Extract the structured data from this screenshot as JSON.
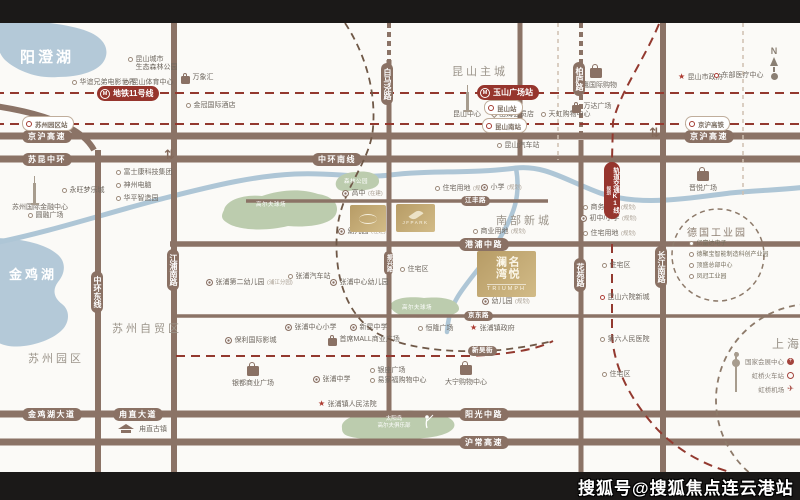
{
  "watermark": "搜狐号@搜狐焦点连云港站",
  "compass": {
    "label": "N"
  },
  "colors": {
    "road": "#8b7366",
    "metro_red": "#96352d",
    "water": "#aec6d6",
    "park": "#bcccae",
    "gold": "#c3ab74"
  },
  "zones": [
    {
      "label": "昆山主城",
      "x": 452,
      "y": 63,
      "size": 11
    },
    {
      "label": "南部新城",
      "x": 496,
      "y": 212,
      "size": 11
    },
    {
      "label": "苏州自贸区",
      "x": 112,
      "y": 320,
      "size": 11
    },
    {
      "label": "苏州园区",
      "x": 28,
      "y": 350,
      "size": 11
    },
    {
      "label": "上海",
      "x": 772,
      "y": 335,
      "size": 12
    }
  ],
  "lakes": [
    {
      "label": "阳澄湖",
      "x": 20,
      "y": 46,
      "size": 15
    },
    {
      "label": "金鸡湖",
      "x": 9,
      "y": 264,
      "size": 13
    }
  ],
  "roads_h": [
    {
      "label": "京沪高速",
      "x": 22,
      "y": 130
    },
    {
      "label": "京沪高速",
      "x": 684,
      "y": 130
    },
    {
      "label": "苏昆中环",
      "x": 22,
      "y": 153
    },
    {
      "label": "中环南线",
      "x": 312,
      "y": 153
    },
    {
      "label": "江丰路",
      "x": 461,
      "y": 196,
      "sm": true
    },
    {
      "label": "港浦中路",
      "x": 459,
      "y": 238
    },
    {
      "label": "京东路",
      "x": 464,
      "y": 311,
      "sm": true
    },
    {
      "label": "新吴街",
      "x": 468,
      "y": 346,
      "sm": true
    },
    {
      "label": "金鸡湖大道",
      "x": 22,
      "y": 408
    },
    {
      "label": "甪直大道",
      "x": 113,
      "y": 408
    },
    {
      "label": "阳光中路",
      "x": 459,
      "y": 408
    },
    {
      "label": "沪常高速",
      "x": 459,
      "y": 436
    }
  ],
  "roads_v": [
    {
      "label": "中环东线",
      "x": 91,
      "y": 271
    },
    {
      "label": "江浦南路",
      "x": 167,
      "y": 249
    },
    {
      "label": "白马泾路",
      "x": 381,
      "y": 63
    },
    {
      "label": "振兴路",
      "x": 384,
      "y": 251,
      "sm": true
    },
    {
      "label": "柏庐路",
      "x": 573,
      "y": 62
    },
    {
      "label": "花苑路",
      "x": 574,
      "y": 258
    },
    {
      "label": "长江南路",
      "x": 655,
      "y": 246
    }
  ],
  "metro_badges": [
    {
      "label": "地铁11号线",
      "x": 97,
      "y": 86
    },
    {
      "label": "玉山广场站",
      "x": 477,
      "y": 85
    }
  ],
  "k1_badge": {
    "label": "轨道交通K1线",
    "sub": "规划",
    "x": 604,
    "y": 162
  },
  "stations": [
    {
      "label": "苏州园区站",
      "x": 22,
      "y": 116
    },
    {
      "label": "昆山站",
      "x": 484,
      "y": 100
    },
    {
      "label": "昆山南站",
      "x": 482,
      "y": 118
    },
    {
      "label": "京沪高铁",
      "x": 685,
      "y": 116
    }
  ],
  "pois": [
    {
      "m": "dot",
      "label": "昆山城市",
      "label2": "生态森林公园",
      "x": 128,
      "y": 56
    },
    {
      "m": "dot",
      "label": "昆山体育中心",
      "x": 124,
      "y": 79
    },
    {
      "m": "bag",
      "label": "万象汇",
      "x": 181,
      "y": 74
    },
    {
      "m": "dot",
      "label": "华谊兄弟电影世界",
      "x": 72,
      "y": 79
    },
    {
      "m": "dot",
      "label": "金冠国际酒店",
      "x": 186,
      "y": 102
    },
    {
      "m": "dot",
      "label": "富士康科技集团",
      "x": 116,
      "y": 169
    },
    {
      "m": "dot",
      "label": "神州电脑",
      "x": 116,
      "y": 182
    },
    {
      "m": "dot",
      "label": "华平智造园",
      "x": 116,
      "y": 195
    },
    {
      "m": "dot",
      "label": "永旺梦乐城",
      "x": 62,
      "y": 187
    },
    {
      "m": "none",
      "label": "苏州国际金融中心",
      "x": 12,
      "y": 204
    },
    {
      "m": "dot",
      "label": "圆融广场",
      "x": 28,
      "y": 212
    },
    {
      "m": "dot",
      "label": "昆山汽车站",
      "x": 497,
      "y": 142
    },
    {
      "m": "star",
      "label": "昆山市政府",
      "x": 678,
      "y": 74
    },
    {
      "m": "rdot",
      "label": "东部医疗中心",
      "x": 714,
      "y": 72
    },
    {
      "m": "none",
      "label": "昆山中心",
      "x": 453,
      "y": 111
    },
    {
      "m": "diamond",
      "label": "山姆会员店",
      "x": 492,
      "y": 111
    },
    {
      "m": "dot",
      "label": "天虹购物中心",
      "x": 541,
      "y": 111
    },
    {
      "m": "bag",
      "label": "万达广场",
      "x": 572,
      "y": 103
    },
    {
      "m": "ring",
      "label": "高中",
      "sub": "(在建)",
      "x": 342,
      "y": 190
    },
    {
      "m": "ring",
      "label": "幼儿园",
      "sub": "(在建)",
      "x": 338,
      "y": 228
    },
    {
      "m": "dot",
      "label": "住宅用地",
      "sub": "(规划)",
      "x": 435,
      "y": 185
    },
    {
      "m": "ring",
      "label": "小学",
      "sub": "(规划)",
      "x": 481,
      "y": 184
    },
    {
      "m": "dot",
      "label": "商业用地",
      "sub": "(规划)",
      "x": 473,
      "y": 228
    },
    {
      "m": "dot",
      "label": "住宅区",
      "x": 400,
      "y": 266
    },
    {
      "m": "ring",
      "label": "张浦第二幼儿园",
      "sub": "(浦江分园)",
      "x": 206,
      "y": 279
    },
    {
      "m": "dot",
      "label": "张浦汽车站",
      "x": 288,
      "y": 273
    },
    {
      "m": "ring",
      "label": "张浦中心幼儿园",
      "x": 330,
      "y": 279
    },
    {
      "m": "ring",
      "label": "张浦中心小学",
      "x": 285,
      "y": 324
    },
    {
      "m": "ring",
      "label": "新昆中学",
      "x": 350,
      "y": 324
    },
    {
      "m": "dot",
      "label": "恒隆广场",
      "x": 418,
      "y": 325
    },
    {
      "m": "star",
      "label": "张浦镇政府",
      "x": 470,
      "y": 325
    },
    {
      "m": "ring",
      "label": "保利国际影城",
      "x": 225,
      "y": 337
    },
    {
      "m": "bag",
      "label": "首席MALL商业广场",
      "x": 328,
      "y": 336
    },
    {
      "m": "ring",
      "label": "张浦中学",
      "x": 313,
      "y": 376
    },
    {
      "m": "dot",
      "label": "银座广场",
      "x": 370,
      "y": 367
    },
    {
      "m": "dot",
      "label": "易家福购物中心",
      "x": 370,
      "y": 377
    },
    {
      "m": "star",
      "label": "张浦镇人民法院",
      "x": 318,
      "y": 401
    },
    {
      "m": "rdot",
      "label": "昆山六院新城",
      "x": 600,
      "y": 294
    },
    {
      "m": "dot",
      "label": "住宅区",
      "x": 602,
      "y": 262
    },
    {
      "m": "dot",
      "label": "第六人民医院",
      "x": 600,
      "y": 336
    },
    {
      "m": "dot",
      "label": "住宅区",
      "x": 602,
      "y": 371
    },
    {
      "m": "ring",
      "label": "幼儿园",
      "sub": "(规划)",
      "x": 482,
      "y": 298
    },
    {
      "m": "dot",
      "label": "商务用地",
      "sub": "(规划)",
      "x": 583,
      "y": 204
    },
    {
      "m": "ring",
      "label": "初中/小学",
      "sub": "(规划)",
      "x": 580,
      "y": 215
    },
    {
      "m": "dot",
      "label": "住宅用地",
      "sub": "(规划)",
      "x": 583,
      "y": 230
    },
    {
      "m": "none",
      "label": "甪直古镇",
      "x": 139,
      "y": 426
    }
  ],
  "malls": [
    {
      "label": "金鹰国际购物",
      "x": 596,
      "y": 64
    },
    {
      "label": "晋悦广场",
      "x": 703,
      "y": 167
    },
    {
      "label": "银都商业广场",
      "x": 253,
      "y": 362
    },
    {
      "label": "大宁购物中心",
      "x": 466,
      "y": 361
    }
  ],
  "germany_park": {
    "title": "德国工业园",
    "tx": 687,
    "ty": 224,
    "items": [
      {
        "label": "亿富达电子",
        "x": 689,
        "y": 238
      },
      {
        "label": "德聚宝智能制造科创产业园",
        "x": 689,
        "y": 249
      },
      {
        "label": "顶盛总部中心",
        "x": 689,
        "y": 260
      },
      {
        "label": "凤冠工业园",
        "x": 689,
        "y": 271
      }
    ]
  },
  "shanghai": {
    "items": [
      {
        "label": "国家会展中心",
        "icon": "expo",
        "y": 356
      },
      {
        "label": "虹桥火车站",
        "icon": "rail",
        "y": 370
      },
      {
        "label": "虹桥机场",
        "icon": "plane",
        "y": 384
      }
    ]
  },
  "park_labels": [
    {
      "label": "森林公园",
      "x": 344,
      "y": 177
    },
    {
      "label": "高尔夫球场",
      "x": 256,
      "y": 200
    },
    {
      "label": "高尔夫球场",
      "x": 402,
      "y": 303
    }
  ],
  "golf_club": {
    "line1": "太阳岛",
    "line2": "高尔夫俱乐部"
  },
  "projects": {
    "jfpark": {
      "en": "JFPARK"
    },
    "triumph": {
      "cn": "名悦澜湾",
      "en": "TRIUMPH"
    }
  }
}
